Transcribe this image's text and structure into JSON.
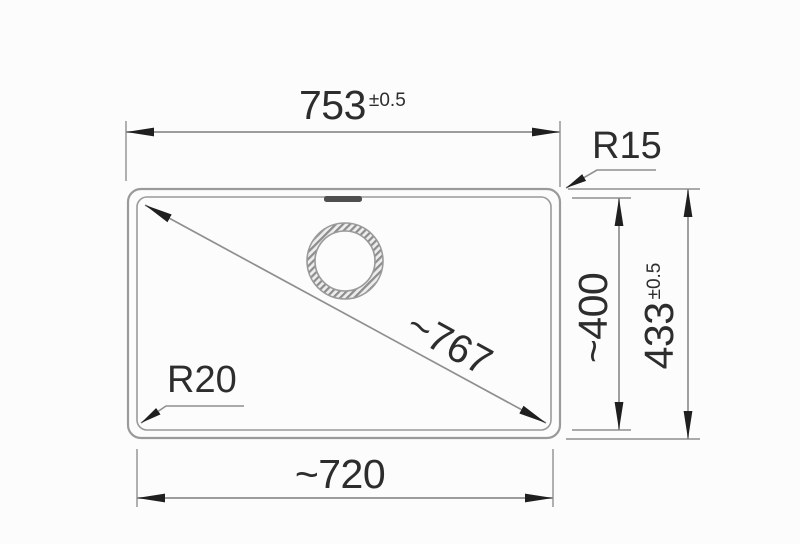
{
  "drawing": {
    "title": "sink-dimension-drawing",
    "type": "technical top-view dimension drawing of a rectangular sink bowl with tap hole and overflow slot",
    "dimensions": {
      "top_width": {
        "value": "753",
        "tolerance": "±0.5"
      },
      "outer_height": {
        "value": "433",
        "tolerance": "±0.5"
      },
      "inner_height": {
        "value": "~400"
      },
      "inner_width": {
        "value": "~720"
      },
      "diagonal": {
        "value": "~767"
      },
      "corner_radius_outer": {
        "value": "R15"
      },
      "corner_radius_inner": {
        "value": "R20"
      }
    },
    "colors": {
      "background": "#fcfcfc",
      "outline": "#9a9a9a",
      "dimension_line": "#8f8f8f",
      "arrow": "#1f1f1f",
      "text": "#2d2d2d",
      "slot": "#4f4f4f",
      "hatch": "#8d8d8d"
    }
  }
}
